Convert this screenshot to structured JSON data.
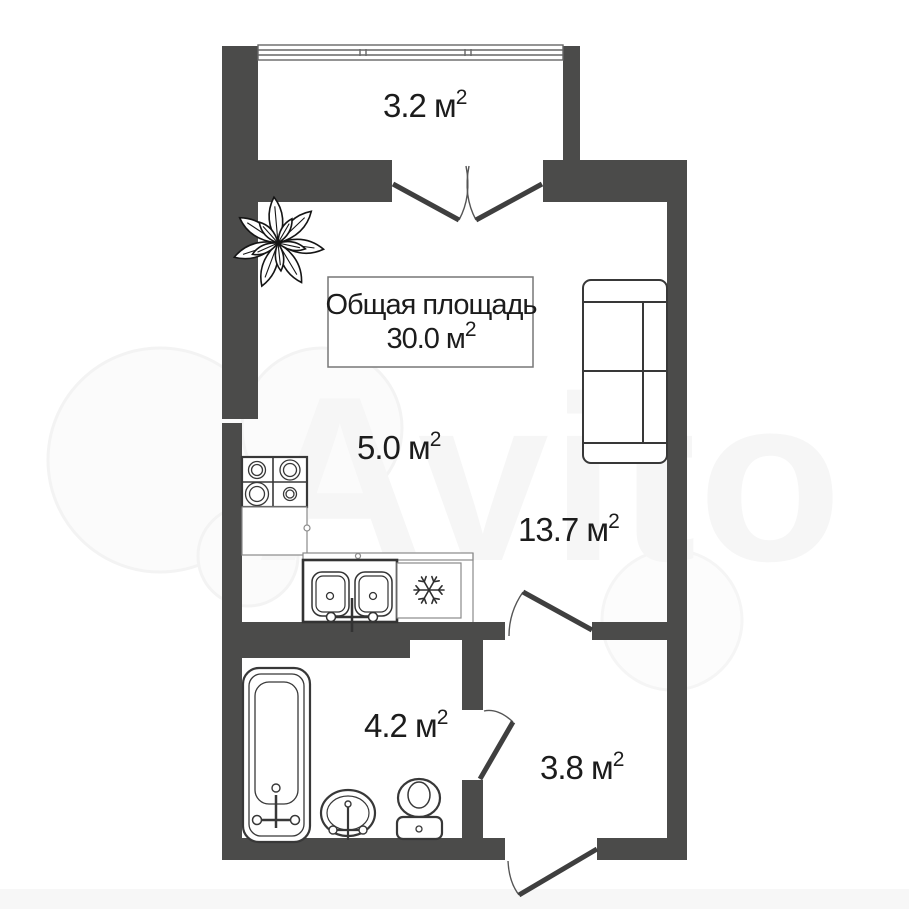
{
  "plan": {
    "title": {
      "line1": "Общая площадь",
      "area": "30.0 м",
      "sup": "2"
    },
    "rooms": {
      "balcony": {
        "area": "3.2 м",
        "sup": "2"
      },
      "kitchen": {
        "area": "5.0 м",
        "sup": "2"
      },
      "living": {
        "area": "13.7 м",
        "sup": "2"
      },
      "bathroom": {
        "area": "4.2 м",
        "sup": "2"
      },
      "hallway": {
        "area": "3.8 м",
        "sup": "2"
      }
    },
    "watermark": "Avito",
    "colors": {
      "wall": "#4b4b4a",
      "furniture_line": "#383838",
      "text": "#1c1c1c",
      "watermark": "#f6f6f6"
    }
  }
}
